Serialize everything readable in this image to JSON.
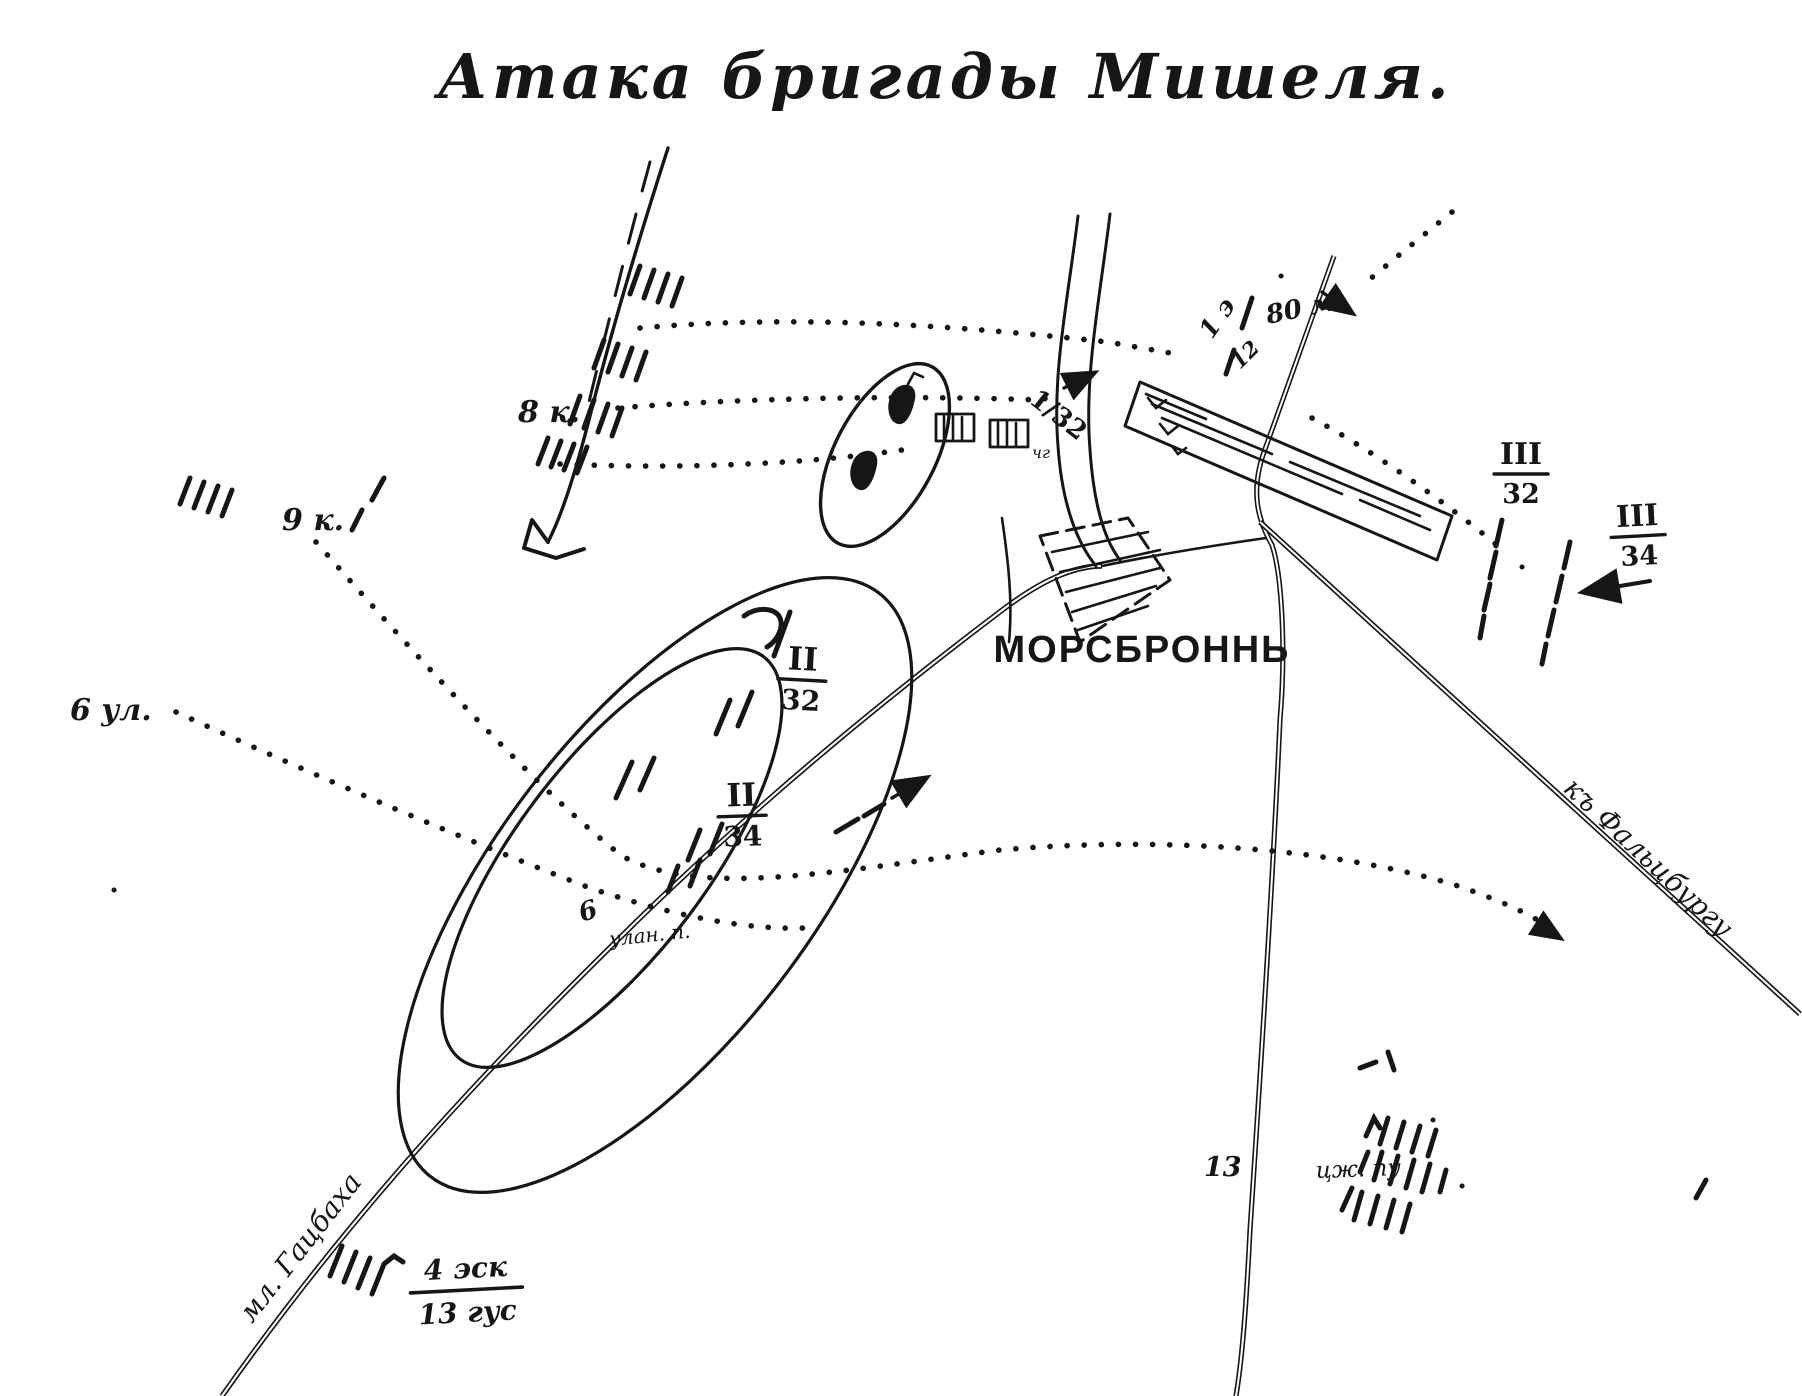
{
  "title": "Атака бригады Мишеля.",
  "village": {
    "name": "МОРСБРОННЬ",
    "house_mark": "чг"
  },
  "french_units": {
    "cuirassiers_8": "8 к.",
    "cuirassiers_9": "9 к.",
    "lancers_6": "6 ул.",
    "lancers_6_road_num": "6",
    "lancers_6_road_script": "улан. п."
  },
  "german_units": {
    "bn_1_32": "1/32",
    "bn_III_32": {
      "num": "III",
      "den": "32"
    },
    "bn_III_34": {
      "num": "III",
      "den": "34"
    },
    "bn_II_32": {
      "num": "II",
      "den": "32"
    },
    "bn_II_34": {
      "num": "II",
      "den": "34"
    },
    "sq_4_13": {
      "num": "4 эск",
      "den": "13 гус"
    },
    "mark_1e": "1 э",
    "mark_12": "12",
    "mark_80m": "80 м",
    "inf_13": "13",
    "inf_13_script": "цж. пу"
  },
  "roads": {
    "to_hatzbach": "мл. Гацбаха",
    "to_phalsbourg": "къ Фальцбургу"
  },
  "colors": {
    "ink": "#161616",
    "paper": "#ffffff"
  }
}
